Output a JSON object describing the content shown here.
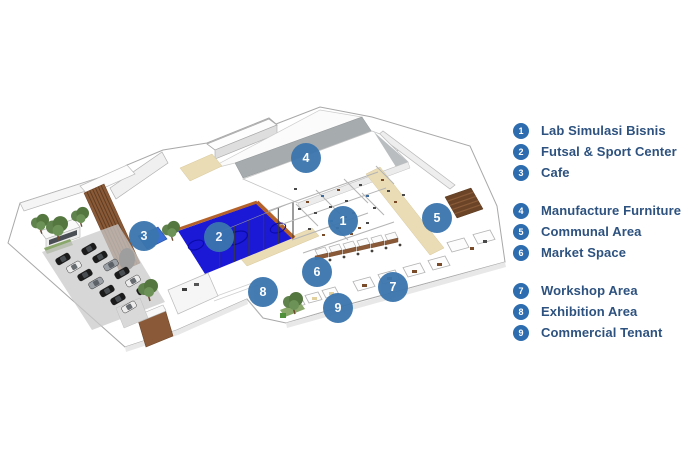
{
  "legend": {
    "groups": [
      {
        "items": [
          {
            "num": "1",
            "label": "Lab Simulasi Bisnis"
          },
          {
            "num": "2",
            "label": "Futsal & Sport Center"
          },
          {
            "num": "3",
            "label": "Cafe"
          }
        ]
      },
      {
        "items": [
          {
            "num": "4",
            "label": "Manufacture Furniture"
          },
          {
            "num": "5",
            "label": "Communal Area"
          },
          {
            "num": "6",
            "label": "Market Space"
          }
        ]
      },
      {
        "items": [
          {
            "num": "7",
            "label": "Workshop Area"
          },
          {
            "num": "8",
            "label": "Exhibition Area"
          },
          {
            "num": "9",
            "label": "Commercial Tenant"
          }
        ]
      }
    ]
  },
  "map": {
    "type": "isometric-floor-plan",
    "markers": [
      {
        "num": "1",
        "label": "Lab Simulasi Bisnis",
        "x": 343,
        "y": 221
      },
      {
        "num": "2",
        "label": "Futsal & Sport Center",
        "x": 219,
        "y": 237
      },
      {
        "num": "3",
        "label": "Cafe",
        "x": 144,
        "y": 236
      },
      {
        "num": "4",
        "label": "Manufacture Furniture",
        "x": 306,
        "y": 158
      },
      {
        "num": "5",
        "label": "Communal Area",
        "x": 437,
        "y": 218
      },
      {
        "num": "6",
        "label": "Market Space",
        "x": 317,
        "y": 272
      },
      {
        "num": "7",
        "label": "Workshop Area",
        "x": 393,
        "y": 287
      },
      {
        "num": "8",
        "label": "Exhibition Area",
        "x": 263,
        "y": 292
      },
      {
        "num": "9",
        "label": "Commercial Tenant",
        "x": 338,
        "y": 308
      }
    ],
    "colors": {
      "marker_blue": "#3b76ae",
      "legend_badge_blue": "#2d6cae",
      "legend_text_blue": "#2d527f",
      "court_blue": "#1b18d6",
      "court_border_orange": "#b5622a",
      "wood_brown": "#8a5a38",
      "roof_gray": "#a6abae",
      "corridor_beige": "#eadcb4",
      "tree_green": "#54763f"
    }
  }
}
